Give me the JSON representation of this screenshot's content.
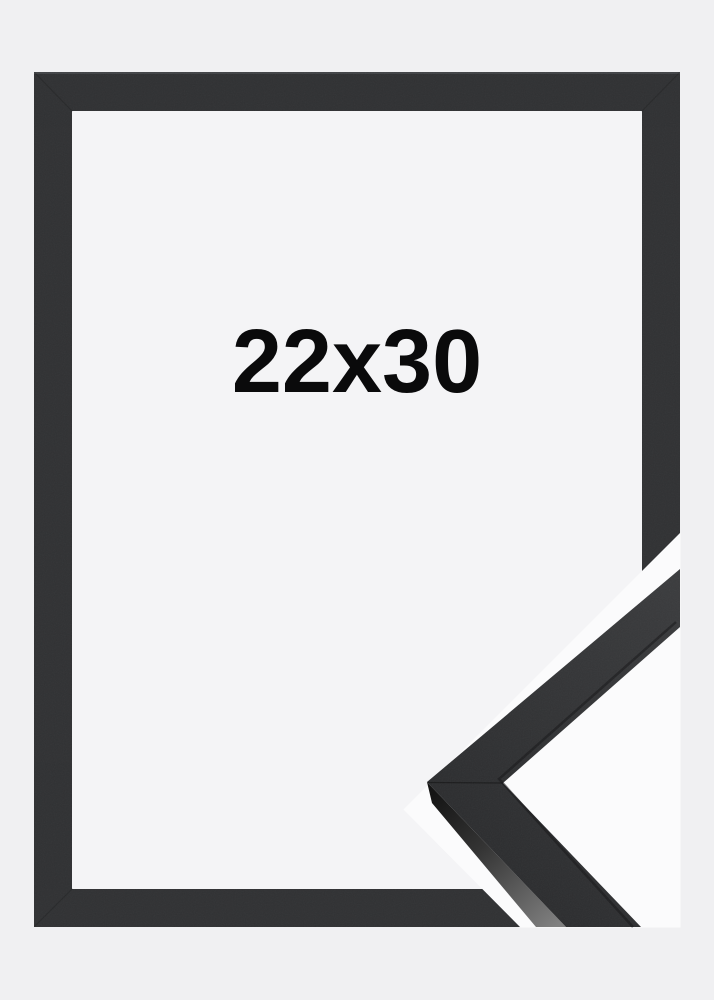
{
  "image": {
    "size_label": "22x30",
    "description_labels": {
      "main_view": "front view of empty black frame",
      "detail_view": "close-up of frame corner moulding profile"
    }
  },
  "colors": {
    "background": "#f0f0f2",
    "frame_moulding": "#303133",
    "frame_top_highlight": "#4b4d50",
    "frame_opening": "#f4f4f6",
    "detail_background": "#fbfbfc",
    "moulding_top_light": "#3b3c3e",
    "moulding_top_dark": "#2c2d2f",
    "moulding_side_dark": "#151515",
    "moulding_side_mid": "#343434",
    "moulding_side_light": "#808080",
    "label_text": "#0a0a0b"
  }
}
